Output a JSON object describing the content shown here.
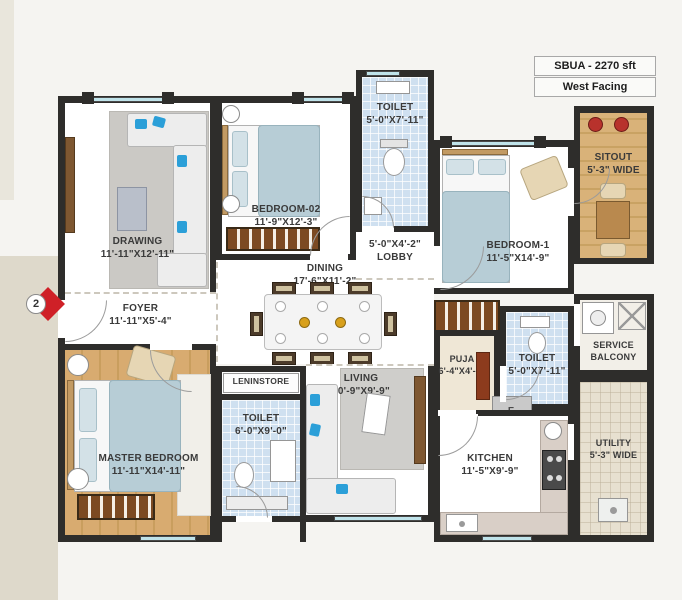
{
  "header": {
    "sbua": "SBUA - 2270 sft",
    "facing": "West Facing"
  },
  "entry_marker": "2",
  "rooms": {
    "drawing": {
      "name": "DRAWING",
      "dim": "11'-11\"X12'-11\""
    },
    "foyer": {
      "name": "FOYER",
      "dim": "11'-11\"X5'-4\""
    },
    "bedroom02": {
      "name": "BEDROOM-02",
      "dim": "11'-9\"X12'-3\""
    },
    "toilet_top": {
      "name": "TOILET",
      "dim": "5'-0\"X7'-11\""
    },
    "lobby": {
      "name": "LOBBY",
      "dim": "5'-0\"X4'-2\""
    },
    "bedroom1": {
      "name": "BEDROOM-1",
      "dim": "11'-5\"X14'-9\""
    },
    "sitout": {
      "name": "SITOUT",
      "dim": "5'-3\" WIDE"
    },
    "dining": {
      "name": "DINING",
      "dim": "17'-6\"X11'-2\""
    },
    "service_balcony": {
      "line1": "SERVICE",
      "line2": "BALCONY"
    },
    "master": {
      "name": "MASTER BEDROOM",
      "dim": "11'-11\"X14'-11\""
    },
    "leninstore": {
      "name": "LENINSTORE"
    },
    "toilet_left": {
      "name": "TOILET",
      "dim": "6'-0\"X9'-0\""
    },
    "living": {
      "name": "LIVING",
      "dim": "10'-9\"X9'-9\""
    },
    "puja": {
      "name": "PUJA",
      "dim": "6'-4\"X4'-5\""
    },
    "toilet_right": {
      "name": "TOILET",
      "dim": "5'-0\"X7'-11\""
    },
    "fridge": {
      "label": "F."
    },
    "kitchen": {
      "name": "KITCHEN",
      "dim": "11'-5\"X9'-9\""
    },
    "utility": {
      "name": "UTILITY",
      "dim": "5'-3\" WIDE"
    }
  },
  "colors": {
    "wall": "#2e2d2b",
    "window": "#bfe3ea",
    "toilet_tile": "#cfe0f0",
    "wood": "#d2a468",
    "accent_red": "#cf2027",
    "pillow_blue": "#2b9fd8"
  }
}
